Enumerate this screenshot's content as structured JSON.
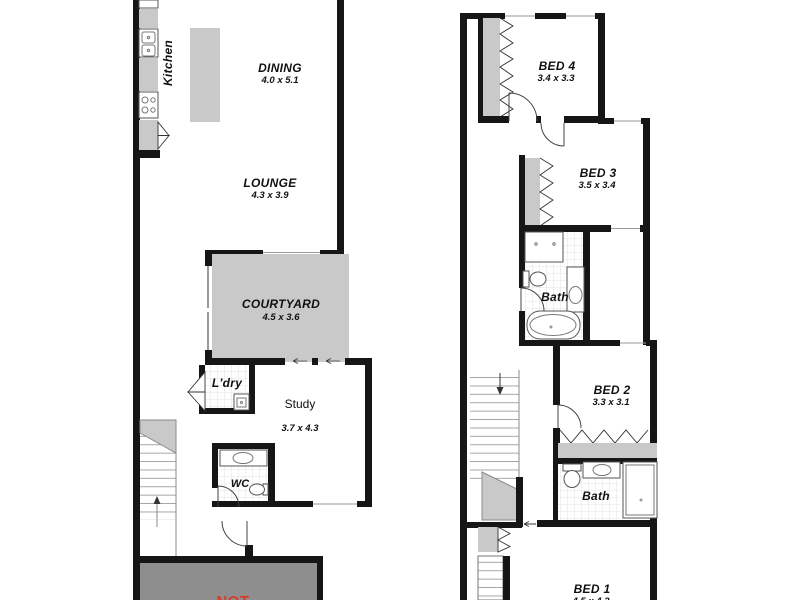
{
  "document": {
    "type": "floorplan",
    "floors": [
      "ground",
      "upper"
    ]
  },
  "ground": {
    "kitchen": {
      "label": "Kitchen"
    },
    "dining": {
      "label": "DINING",
      "dims": "4.0 x 5.1"
    },
    "lounge": {
      "label": "LOUNGE",
      "dims": "4.3 x 3.9"
    },
    "courtyard": {
      "label": "COURTYARD",
      "dims": "4.5 x 3.6"
    },
    "laundry": {
      "label": "L'dry"
    },
    "study": {
      "label": "Study",
      "dims": "3.7 x 4.3"
    },
    "wc": {
      "label": "WC"
    },
    "garage_note": "NOT"
  },
  "upper": {
    "bed4": {
      "label": "BED 4",
      "dims": "3.4 x 3.3"
    },
    "bed3": {
      "label": "BED 3",
      "dims": "3.5 x 3.4"
    },
    "bath_main": {
      "label": "Bath"
    },
    "bed2": {
      "label": "BED 2",
      "dims": "3.3 x 3.1"
    },
    "bath_second": {
      "label": "Bath"
    },
    "bed1": {
      "label": "BED 1",
      "dims": "4.5 x 4.2"
    }
  },
  "colors": {
    "wall": "#161616",
    "room_fill": "#ffffff",
    "courtyard_fill": "#c9c9c9",
    "garage_fill": "#8e8e8e",
    "note_red": "#d93a27"
  }
}
